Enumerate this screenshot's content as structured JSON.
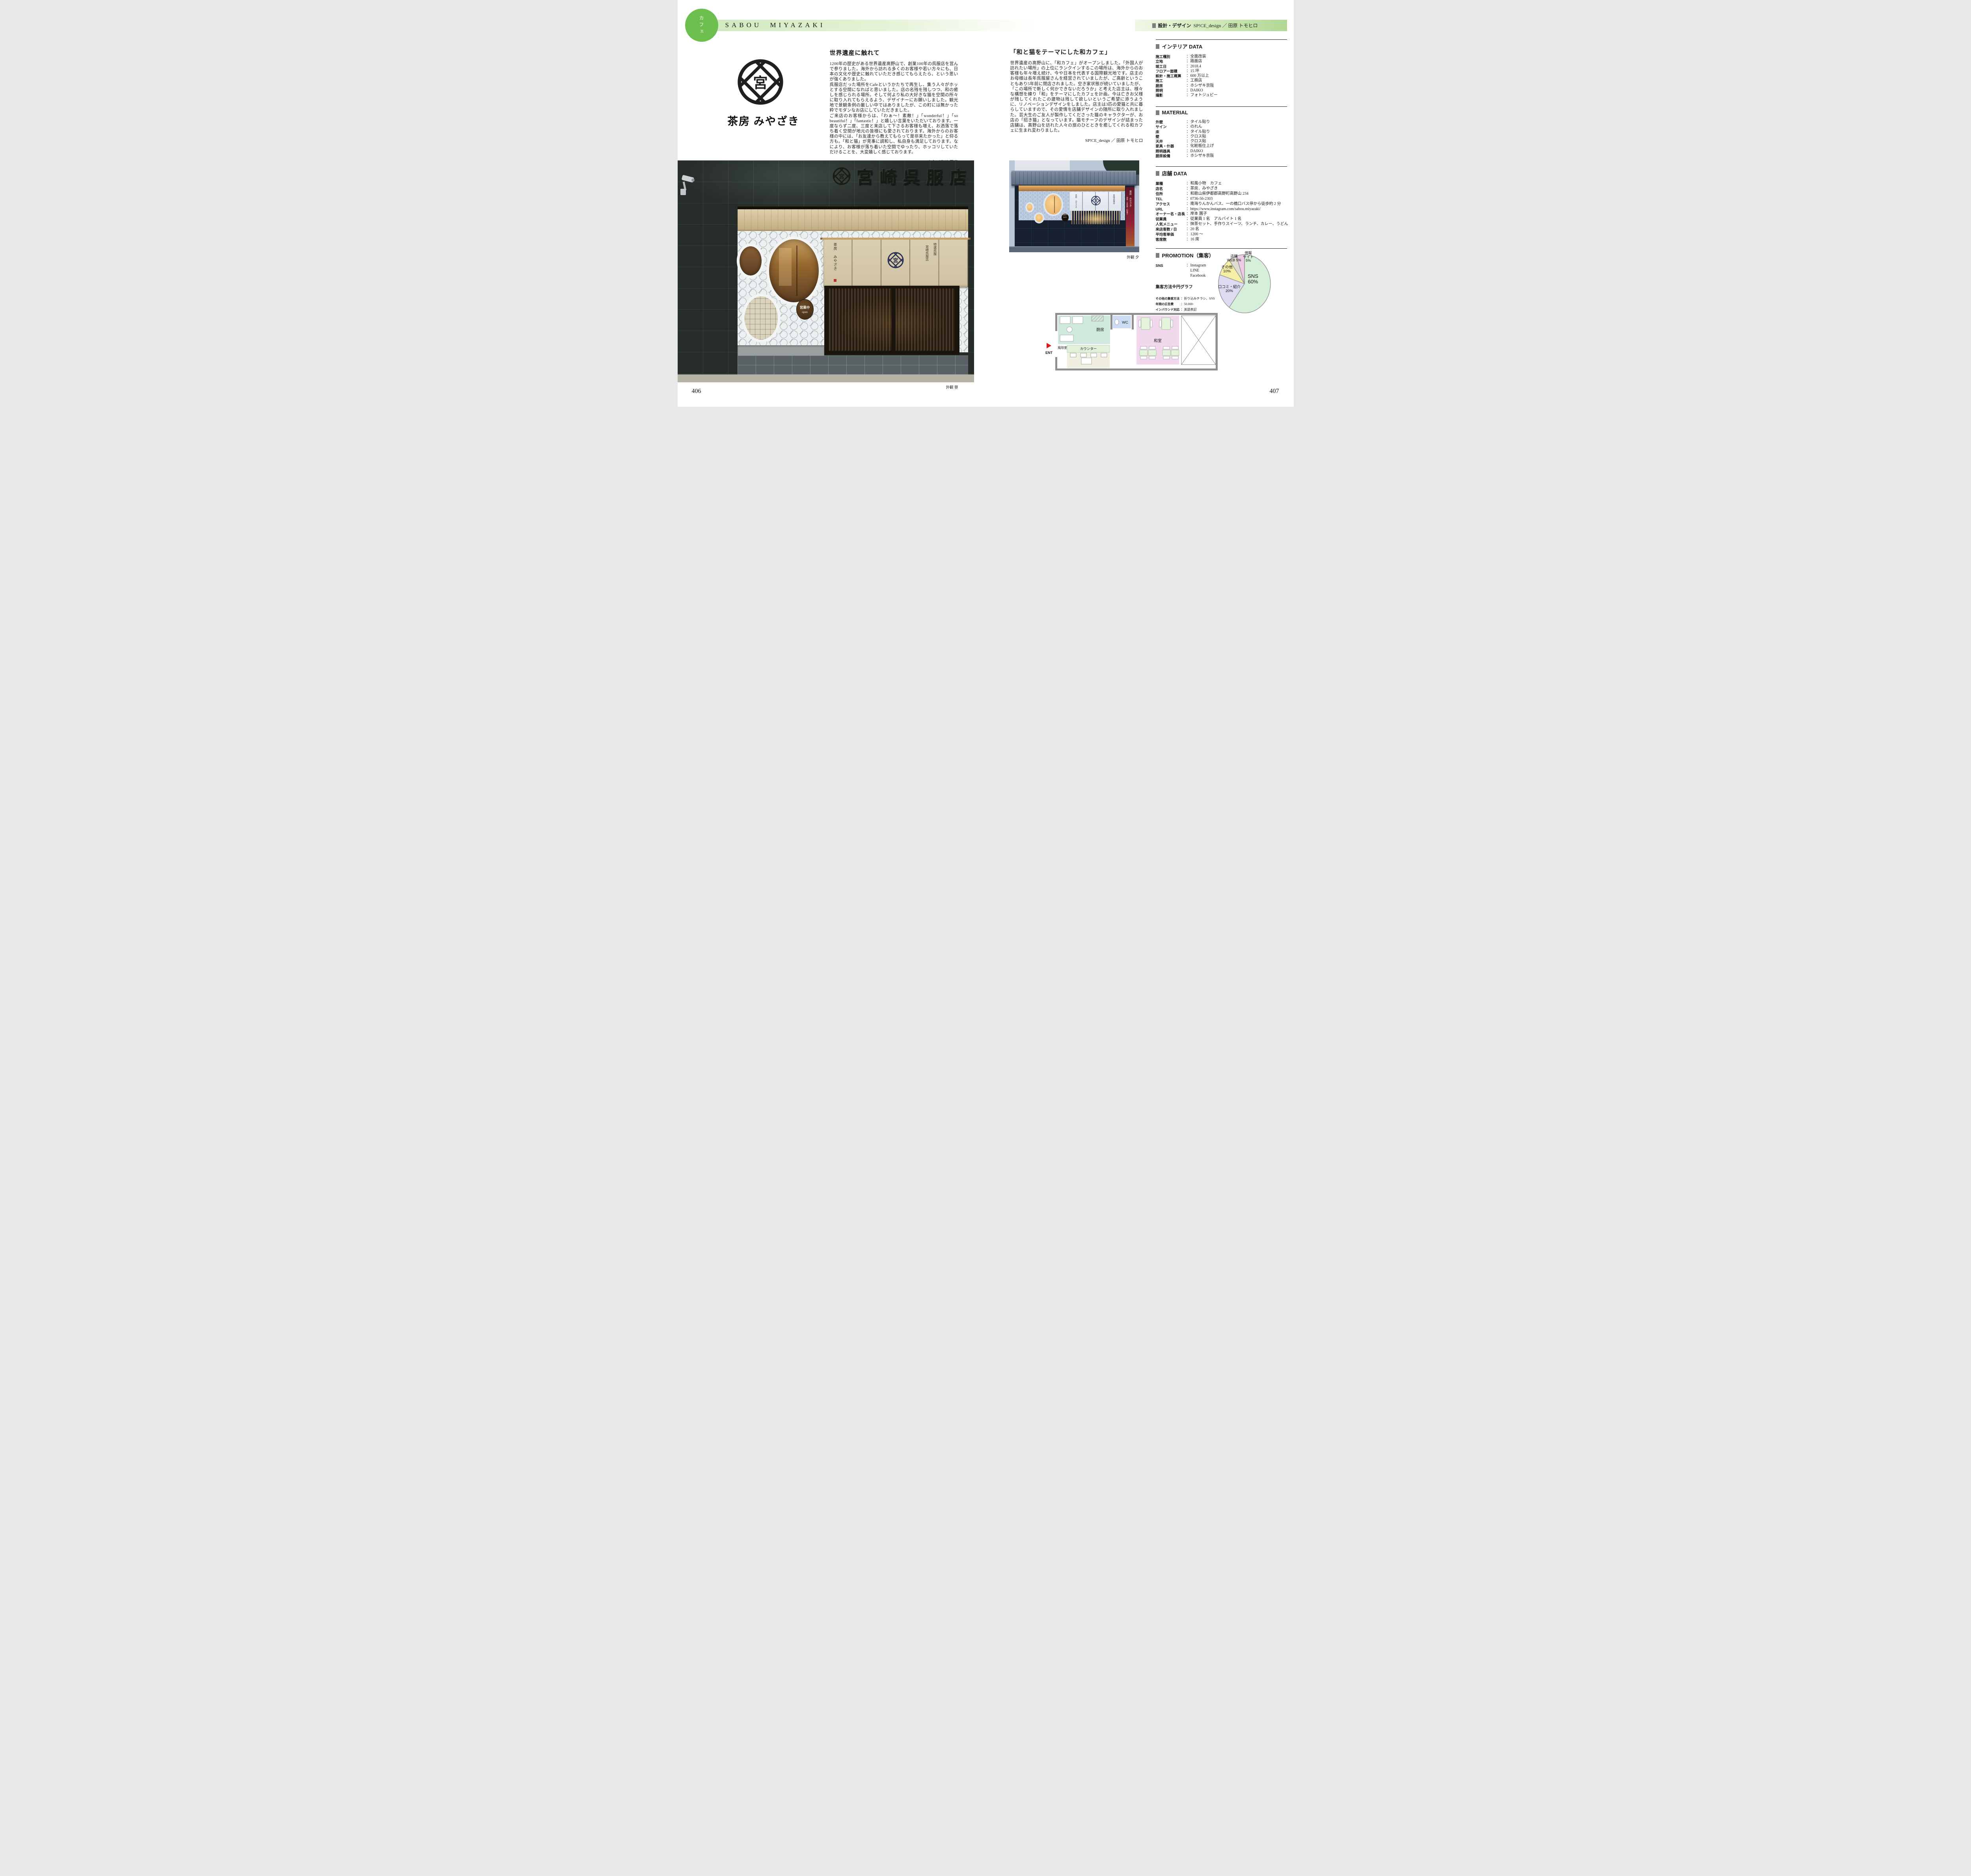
{
  "ui": {
    "colon": "："
  },
  "page": {
    "left_number": "406",
    "right_number": "407"
  },
  "header": {
    "category_vertical": "カフェ",
    "title": "SABOU MIYAZAKI",
    "credit_label": "設計・デザイン",
    "credit_value": "SP!CE_design ／ 田原 トモヒロ"
  },
  "brand": {
    "crest_char": "宮",
    "name": "茶房 みやざき"
  },
  "left_article": {
    "title": "世界遺産に触れて",
    "paragraphs": [
      "1200年の歴史がある世界遺産高野山で、創業100年の呉服店を営んで参りました。海外から訪れる多くのお客様や若い方々にも、日本の文化や歴史に触れていただき感じてもらえたら、という思いが強くありました。",
      "呉服店だった場所をCafeというかたちで再生し、集う人々がホッとする空間になればと思いました。店の名残を残しつつ、和の癒しを感じられる場所。そして何より私の大好きな猫を空間の所々に取り入れてもらえるよう、デザイナーにお願いしました。観光地で景観条例の厳しい中ではありましたが、この町には無かった粋でモダンなお店にしていただきました。",
      "ご来店のお客様からは、「わぁ〜！素敵！」「wonderful！」「so beautiful！」「fantastic！」と嬉しい言葉をいただいております。一度ならず二度、三度と来店して下さるお客様も増え、お洒落で落ち着く空間が地元の皆様にも愛されております。海外からのお客様の中には、「お友達から教えてもらって是非来たかった」と仰る方も。「和と猫」が見事に調和し、私自身も満足しております。なにより、お客様が落ち着いた空間でゆったり、ホッコリしていただけることを、大変嬉しく感じております。"
    ],
    "byline": "店主／宮崎 園子"
  },
  "mid_article": {
    "title": "「和と猫をテーマにした和カフェ」",
    "paragraphs": [
      "世界遺産の高野山に、「和カフェ」がオープンしました。「外国人が訪れたい場所」の上位にランクインするこの場所は、海外からのお客様も年々増え続け、今や日本を代表する国際観光地です。店主のお母様は長年呉服屋さんを経営されていましたが、ご高齢ということもあり5年前に閉店されました。空き家状態が続いていましたが、「この場所で新しく何かできないだろうか」と考えた店主は、様々な構想を練り「和」をテーマにしたカフェを計画。今は亡きお父様が残してくれたこの建物は残して欲しいというご希望に添うように、リノベーションデザインをしました。店主は3匹の愛猫と共に暮らしていますので、その愛情を店舗デザインの随所に取り入れました。芸大生のご友人が製作してくださった猫のキャラクターが、お店の「招き猫」となっています。猫モチーフのデザインが詰まった店舗は、高野山を訪れた人々の旅のひとときを癒してくれる和カフェに生まれ変わりました。"
    ],
    "byline": "SP!CE_design ／ 田原 トモヒロ"
  },
  "interior_data": {
    "heading": "インテリア DATA",
    "rows": [
      {
        "label": "施工種別",
        "value": "全面改装"
      },
      {
        "label": "立地",
        "value": "路面店"
      },
      {
        "label": "竣工日",
        "value": "2018.4"
      },
      {
        "label": "フロアー面積",
        "value": "15 坪"
      },
      {
        "label": "設計・施工概算",
        "value": "600 万以上"
      },
      {
        "label": "施工",
        "value": "工務店"
      },
      {
        "label": "厨房",
        "value": "ホシザキ京阪"
      },
      {
        "label": "照明",
        "value": "DAIKO"
      },
      {
        "label": "撮影",
        "value": "フォトジュピー"
      }
    ]
  },
  "material": {
    "heading": "MATERIAL",
    "rows": [
      {
        "label": "外壁",
        "value": "タイル貼り"
      },
      {
        "label": "サイン",
        "value": "のれん"
      },
      {
        "label": "床",
        "value": "タイル貼り"
      },
      {
        "label": "壁",
        "value": "クロス貼"
      },
      {
        "label": "天井",
        "value": "クロス貼"
      },
      {
        "label": "家具・什器",
        "value": "化粧板仕上げ"
      },
      {
        "label": "照明器具",
        "value": "DAIKO"
      },
      {
        "label": "厨房設備",
        "value": "ホシザキ京阪"
      }
    ]
  },
  "shop_data": {
    "heading": "店舗 DATA",
    "rows": [
      {
        "label": "業種",
        "value": "和風小物　カフェ"
      },
      {
        "label": "店名",
        "value": "茶房．みやざき"
      },
      {
        "label": "住所",
        "value": "和歌山県伊都郡高野町高野山 234"
      },
      {
        "label": "TEL",
        "value": "0736-56-2303"
      },
      {
        "label": "アクセス",
        "value": "南海りんかんバス、一の橋口バス停から徒歩約 2 分"
      },
      {
        "label": "URL",
        "value": "https://www.instagram.com/sabou.miyazaki/"
      },
      {
        "label": "オーナー名・店長",
        "value": "岸本 園子"
      },
      {
        "label": "従業員",
        "value": "従業員 1 名　アルバイト 1 名"
      },
      {
        "label": "人気メニュー",
        "value": "抹茶セット、手作りスイーツ、ランチ、カレー、うどん"
      },
      {
        "label": "来店客数 / 日",
        "value": "20 名"
      },
      {
        "label": "平均客単価",
        "value": "1200 ～"
      },
      {
        "label": "客席数",
        "value": "16 席"
      }
    ]
  },
  "promotion": {
    "heading": "PROMOTION（集客）",
    "sns_label": "SNS",
    "sns_values": [
      "Instagram",
      "LINE",
      "Facebook"
    ],
    "chart_note": "集客方法※円グラフ",
    "rows": [
      {
        "label": "その他の集客方法",
        "value": "折り込みチラシ、SNS"
      },
      {
        "label": "年間の広告費",
        "value": "50.000-"
      },
      {
        "label": "インバウンド対応",
        "value": "英語表記"
      }
    ]
  },
  "chart_data": {
    "type": "pie",
    "title": "集客方法（円グラフ）",
    "categories": [
      "SNS",
      "口コミ・紹介",
      "その他",
      "店舗WEB",
      "情報サイト"
    ],
    "values": [
      60,
      20,
      10,
      5,
      5
    ],
    "slices": [
      {
        "label": "SNS",
        "value": 60,
        "color": "#d6efd9"
      },
      {
        "label": "口コミ・紹介",
        "value": 20,
        "color": "#dddbf2"
      },
      {
        "label": "その他",
        "value": 10,
        "color": "#f4efa5"
      },
      {
        "label": "店舗WEB",
        "value": 5,
        "color": "#dfddd0"
      },
      {
        "label": "情報サイト",
        "value": 5,
        "color": "#eecbe4"
      }
    ],
    "legend_position": "on-slice",
    "start_angle_deg": 0,
    "clockwise": true,
    "outline_color": "#909090"
  },
  "photos": {
    "day": {
      "caption": "外観 昼",
      "sign_text": "宮崎呉服店",
      "open_sign_line1": "営業中",
      "open_sign_line2": "open",
      "noren_left": "茶房 みやざき",
      "noren_right_col1": "特選呉服",
      "noren_right_col2": "宮崎呉服店"
    },
    "dusk": {
      "caption": "外観 夕",
      "sign_text": "宮崎呉服店",
      "open_text": "営業中 open",
      "banner_text": "茶房 みやざき",
      "banner_text2": "・抹茶・日本茶・和菓子"
    }
  },
  "floor_plan": {
    "labels": {
      "kitchen": "厨房",
      "wc": "WC",
      "counter": "カウンター",
      "tatami": "和室",
      "windbreak": "風除室",
      "entrance": "ENT"
    }
  }
}
